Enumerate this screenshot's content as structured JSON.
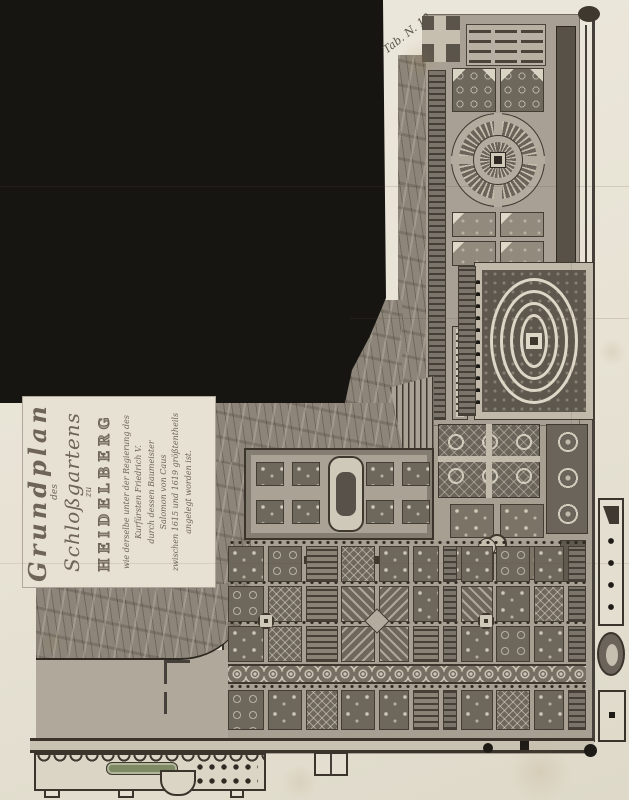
{
  "plate": {
    "label": "Tab. N. 18."
  },
  "cartouche": {
    "line1": "Grundplan",
    "line2": "des",
    "line3": "Schloßgartens",
    "line4": "zu",
    "line5": "HEIDELBERG",
    "dedication": [
      "wie derselbe unter der Regierung des",
      "Kurfürsten Friedrich V.",
      "durch dessen Baumeister",
      "Salomon von Caus",
      "zwischen 1615 und 1619 größtentheils",
      "angelegt worden ist."
    ]
  },
  "palette": {
    "paper": "#e9e4d7",
    "ink": "#3a342c",
    "missing_area_black": "#171512",
    "slope_gray": "#8d8579",
    "garden_ground": "#a79f92",
    "bed_dark": "#6e675c",
    "path_light": "#cfc9ba",
    "water_green": "#7d8a64"
  }
}
